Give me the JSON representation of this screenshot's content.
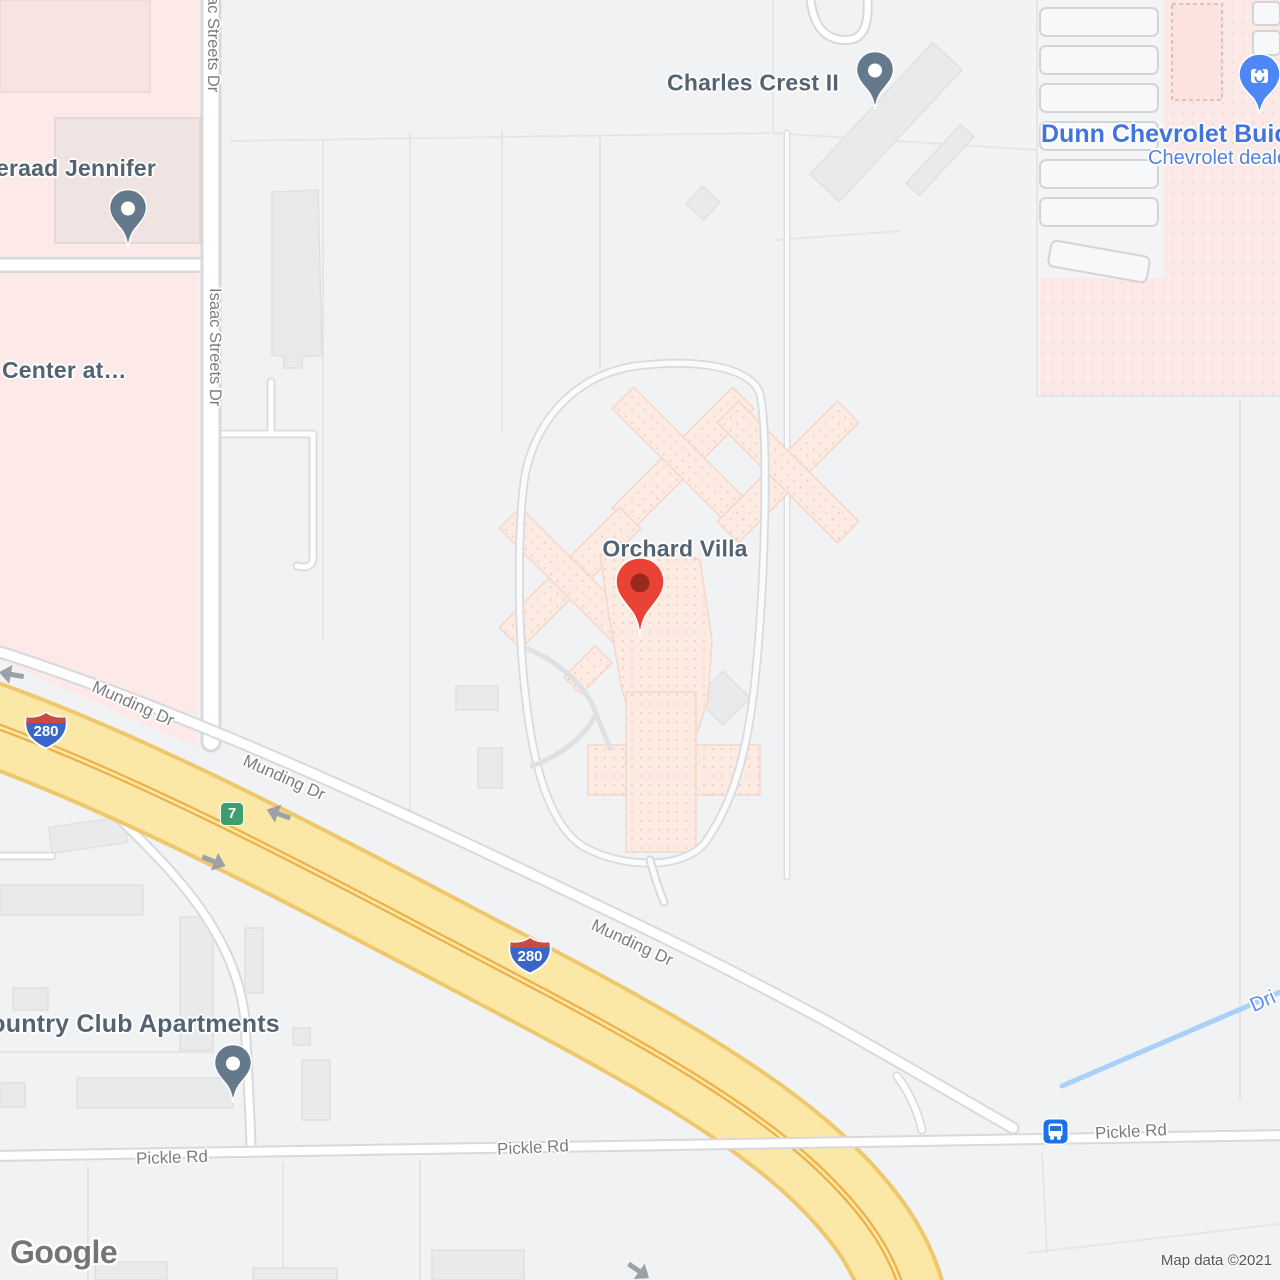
{
  "attribution": "Map data ©2021",
  "watermark": "Google",
  "places": {
    "orchard_villa": "Orchard Villa",
    "charles_crest": "Charles Crest II",
    "jennifer": "eraad Jennifer",
    "center_at": "Center at…",
    "dunn_title": "Dunn Chevrolet Buick",
    "dunn_subtitle": "Chevrolet dealer",
    "country_club": "Country Club Apartments"
  },
  "roads": {
    "isaac": "Isaac Streets Dr",
    "munding": "Munding Dr",
    "pickle": "Pickle Rd",
    "stream": "Dri",
    "interstate": "280",
    "exit": "7"
  },
  "colors": {
    "pin_red": "#EA4335",
    "pin_slate": "#64798C",
    "poi_label": "#546372",
    "road_label": "#7B7D80",
    "business_blue": "#4374DD",
    "water_blue": "#A9D0F8",
    "highway_fill": "#FBE7A3",
    "highway_casing": "#EFC76D",
    "transit_blue": "#1A73E8",
    "exit_green": "#3F9E70"
  }
}
